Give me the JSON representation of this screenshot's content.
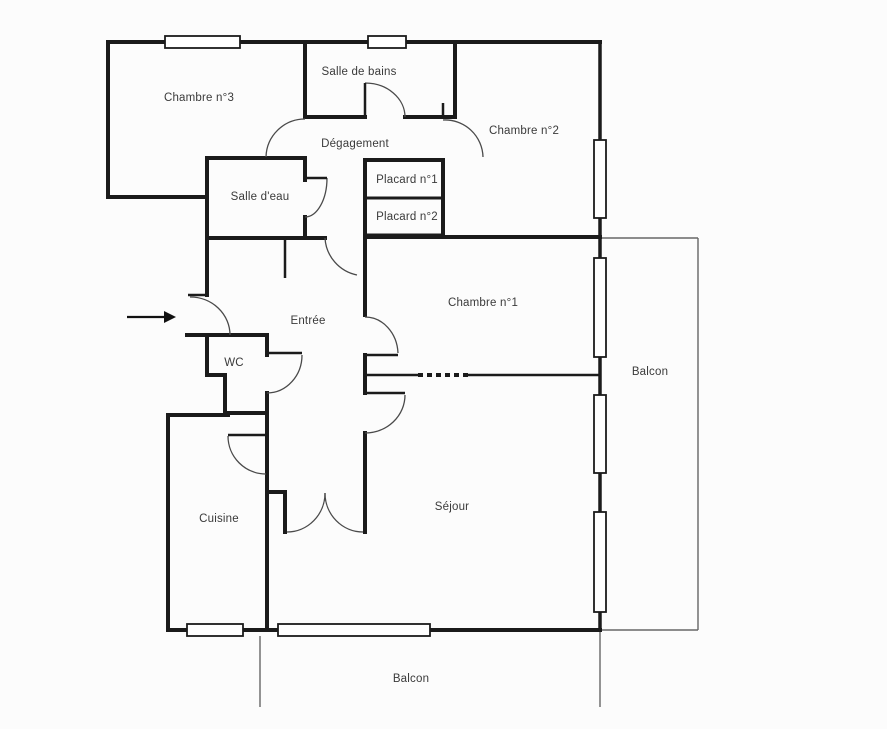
{
  "meta": {
    "document_type": "apartment floor plan",
    "language": "French"
  },
  "colors": {
    "background": "#fcfcfc",
    "wall": "#1b1b1b",
    "door_arc": "#4a4a4a",
    "balcony_line": "#666666",
    "window_fill": "#ffffff",
    "label_text": "#3a3a3a",
    "arrow": "#111111"
  },
  "rooms": [
    {
      "id": "chambre-3",
      "label": "Chambre n°3",
      "x": 199,
      "y": 98
    },
    {
      "id": "salle-de-bains",
      "label": "Salle de bains",
      "x": 359,
      "y": 72
    },
    {
      "id": "chambre-2",
      "label": "Chambre n°2",
      "x": 524,
      "y": 131
    },
    {
      "id": "degagement",
      "label": "Dégagement",
      "x": 355,
      "y": 144
    },
    {
      "id": "salle-d-eau",
      "label": "Salle d'eau",
      "x": 260,
      "y": 197
    },
    {
      "id": "placard-1",
      "label": "Placard n°1",
      "x": 407,
      "y": 180
    },
    {
      "id": "placard-2",
      "label": "Placard n°2",
      "x": 407,
      "y": 217
    },
    {
      "id": "chambre-1",
      "label": "Chambre n°1",
      "x": 483,
      "y": 303
    },
    {
      "id": "entree",
      "label": "Entrée",
      "x": 308,
      "y": 321
    },
    {
      "id": "wc",
      "label": "WC",
      "x": 234,
      "y": 363
    },
    {
      "id": "balcon-droit",
      "label": "Balcon",
      "x": 650,
      "y": 372
    },
    {
      "id": "cuisine",
      "label": "Cuisine",
      "x": 219,
      "y": 519
    },
    {
      "id": "sejour",
      "label": "Séjour",
      "x": 452,
      "y": 507
    },
    {
      "id": "balcon-bas",
      "label": "Balcon",
      "x": 411,
      "y": 679
    }
  ],
  "floorplan": {
    "walls": [
      [
        108,
        42,
        600,
        42,
        4
      ],
      [
        108,
        42,
        108,
        197,
        4
      ],
      [
        108,
        197,
        207,
        197,
        4
      ],
      [
        305,
        42,
        305,
        117,
        4
      ],
      [
        455,
        42,
        455,
        117,
        4
      ],
      [
        305,
        117,
        365,
        117,
        4
      ],
      [
        405,
        117,
        455,
        117,
        4
      ],
      [
        207,
        158,
        305,
        158,
        4
      ],
      [
        207,
        158,
        207,
        295,
        4
      ],
      [
        207,
        238,
        325,
        238,
        4
      ],
      [
        305,
        158,
        305,
        180,
        4
      ],
      [
        305,
        217,
        305,
        238,
        4
      ],
      [
        365,
        160,
        443,
        160,
        4
      ],
      [
        365,
        160,
        365,
        237,
        4
      ],
      [
        443,
        160,
        443,
        235,
        4
      ],
      [
        365,
        198,
        443,
        198,
        3
      ],
      [
        365,
        235,
        443,
        235,
        3
      ],
      [
        365,
        237,
        600,
        237,
        4
      ],
      [
        365,
        237,
        365,
        315,
        4
      ],
      [
        365,
        355,
        365,
        393,
        4
      ],
      [
        365,
        433,
        365,
        532,
        4
      ],
      [
        187,
        335,
        267,
        335,
        4
      ],
      [
        207,
        335,
        207,
        375,
        4
      ],
      [
        207,
        375,
        225,
        375,
        4
      ],
      [
        225,
        375,
        225,
        415,
        4
      ],
      [
        225,
        413,
        267,
        413,
        4
      ],
      [
        267,
        335,
        267,
        355,
        4
      ],
      [
        267,
        393,
        267,
        630,
        4
      ],
      [
        267,
        492,
        285,
        492,
        4
      ],
      [
        285,
        492,
        285,
        532,
        4
      ],
      [
        168,
        415,
        228,
        415,
        4
      ],
      [
        168,
        415,
        168,
        630,
        4
      ],
      [
        168,
        630,
        600,
        630,
        4
      ],
      [
        365,
        375,
        418,
        375,
        2.5
      ],
      [
        468,
        375,
        600,
        375,
        2.5
      ],
      [
        600,
        42,
        600,
        140,
        3.5
      ],
      [
        600,
        218,
        600,
        258,
        3.5
      ],
      [
        600,
        357,
        600,
        395,
        3.5
      ],
      [
        600,
        473,
        600,
        512,
        3.5
      ],
      [
        600,
        612,
        600,
        630,
        3.5
      ]
    ],
    "door_leaves": [
      [
        188,
        295,
        207,
        295,
        2.5
      ],
      [
        365,
        83,
        365,
        117,
        2.5
      ],
      [
        443,
        103,
        443,
        117,
        2.5
      ],
      [
        305,
        178,
        327,
        178,
        2.5
      ],
      [
        285,
        238,
        285,
        278,
        2.5
      ],
      [
        267,
        353,
        302,
        353,
        2.5
      ],
      [
        365,
        355,
        398,
        355,
        2.5
      ],
      [
        365,
        393,
        405,
        393,
        2.5
      ],
      [
        228,
        435,
        266,
        435,
        2.5
      ]
    ],
    "dashed_walls": [
      [
        418,
        375,
        468,
        375,
        4
      ]
    ],
    "door_arcs": [
      "M266,157 A39,39 0 0 1 305,119",
      "M365,83 A40,34 0 0 1 405,117",
      "M443,120 A38,38 0 0 1 483,157",
      "M327,178 A22,39 0 0 1 305,217",
      "M325,238 A40,40 0 0 0 357,275",
      "M190,297 A40,38 0 0 1 230,335",
      "M302,355 A35,38 0 0 1 267,393",
      "M398,353 A33,38 0 0 0 365,317",
      "M405,395 A40,38 0 0 1 365,433",
      "M228,436 A38,38 0 0 0 266,474",
      "M325,493 A38,39 0 0 1 287,532",
      "M325,493 A38,39 0 0 0 363,532"
    ],
    "windows": [
      [
        165,
        36,
        75,
        12
      ],
      [
        368,
        36,
        38,
        12
      ],
      [
        594,
        140,
        12,
        78
      ],
      [
        594,
        258,
        12,
        99
      ],
      [
        594,
        395,
        12,
        78
      ],
      [
        594,
        512,
        12,
        100
      ],
      [
        187,
        624,
        56,
        12
      ],
      [
        278,
        624,
        152,
        12
      ]
    ],
    "balcony_lines": [
      [
        600,
        238,
        698,
        238
      ],
      [
        698,
        238,
        698,
        630
      ],
      [
        600,
        630,
        698,
        630
      ],
      [
        260,
        636,
        260,
        707
      ],
      [
        600,
        630,
        600,
        707
      ]
    ],
    "entry_arrow": {
      "x1": 127,
      "y1": 317,
      "x2": 164,
      "y2": 317,
      "head": "164,311 176,317 164,323"
    }
  }
}
